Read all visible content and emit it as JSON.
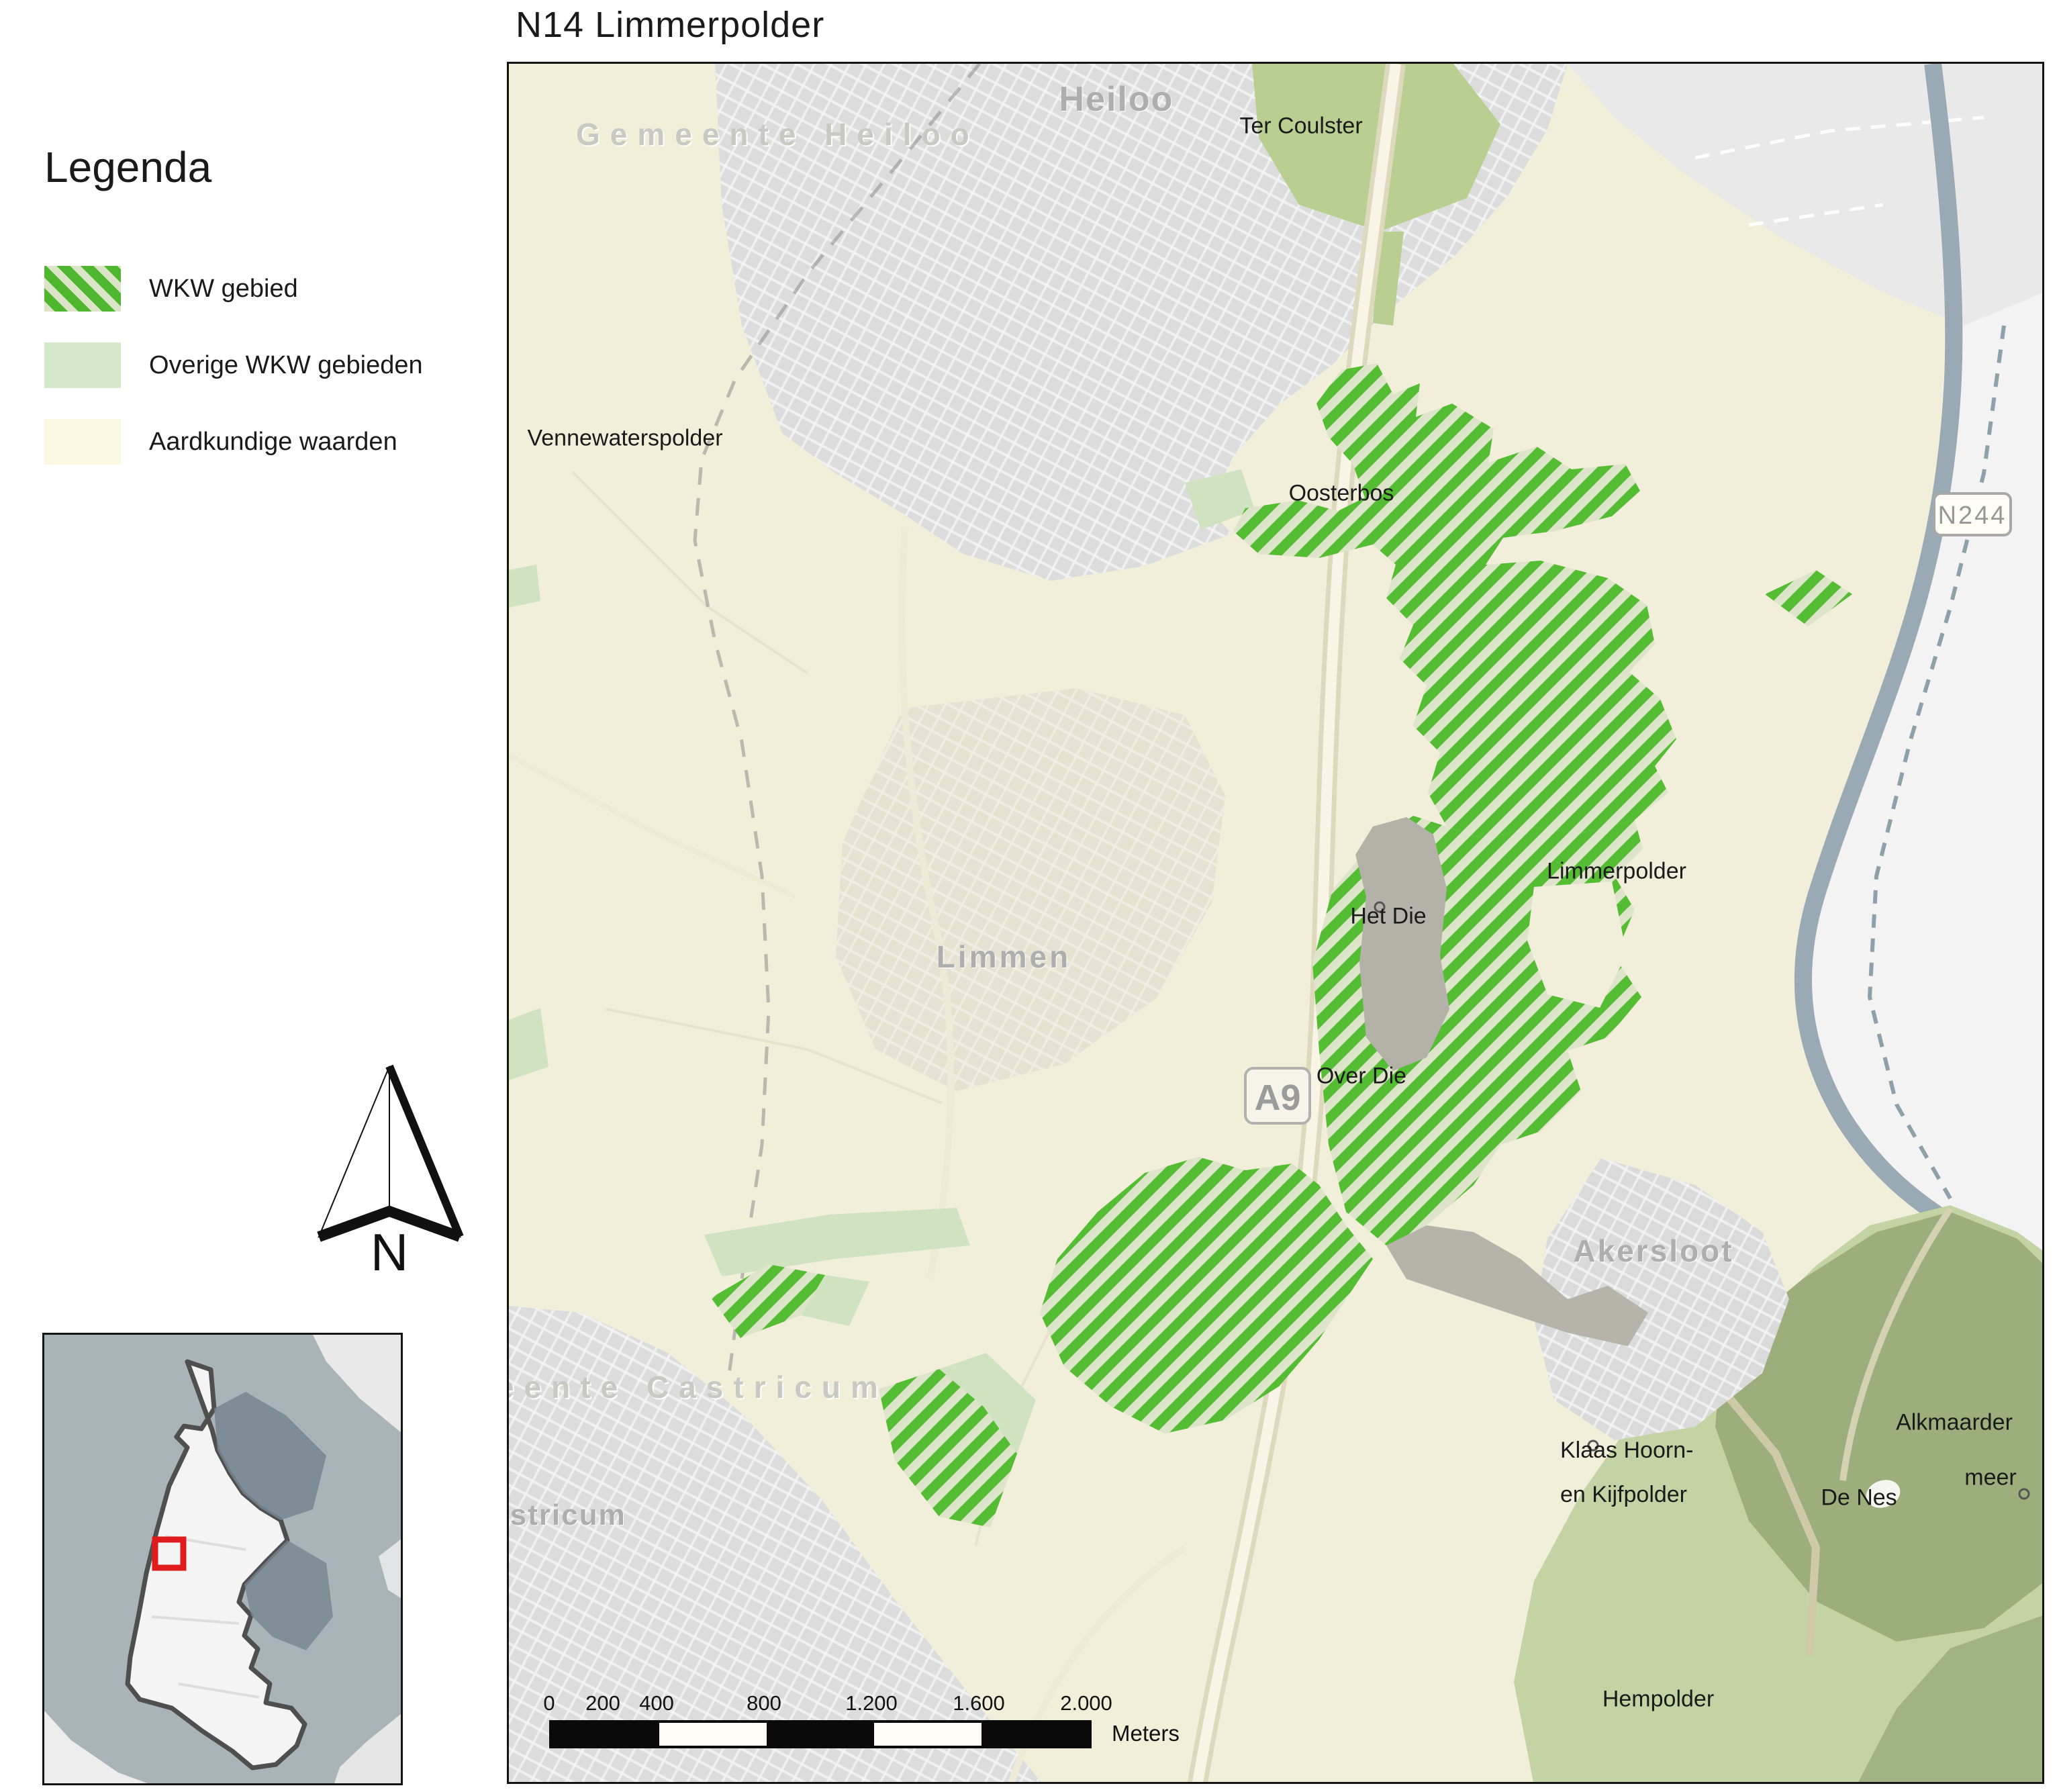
{
  "title": "N14  Limmerpolder",
  "legend": {
    "title": "Legenda",
    "items": [
      {
        "label": "WKW gebied",
        "swatch": "hatched-green"
      },
      {
        "label": "Overige WKW gebieden",
        "swatch": "light-green"
      },
      {
        "label": "Aardkundige waarden",
        "swatch": "cream"
      }
    ]
  },
  "north_arrow_label": "N",
  "scale_bar": {
    "ticks": [
      "0",
      "200",
      "400",
      "800",
      "1.200",
      "1.600",
      "2.000"
    ],
    "unit": "Meters"
  },
  "road_shields": {
    "n244": "N244",
    "a9": "A9"
  },
  "map_labels": {
    "heiloo": "Heiloo",
    "gemeente_heiloo": "Gemeente Heiloo",
    "ter_coulster": "Ter Coulster",
    "vennewaterspolder": "Vennewaterspolder",
    "oosterbos": "Oosterbos",
    "limmerpolder": "Limmerpolder",
    "het_die": "Het Die",
    "limmen": "Limmen",
    "over_die": "Over Die",
    "akersloot": "Akersloot",
    "gemeente_castricum_partial": "eente Castricum",
    "castricum_partial": "astricum",
    "klaas_hoorn_line1": "Klaas Hoorn-",
    "klaas_hoorn_line2": "en Kijfpolder",
    "de_nes": "De Nes",
    "alkmaarder": "Alkmaarder",
    "meer": "meer",
    "hempolder": "Hempolder"
  },
  "colors": {
    "wkw_stripe": "#55bd33",
    "wkw_background": "#dde4c9",
    "overige_wkw": "#cfe3c0",
    "aardkundige_waarden": "#f1eeda",
    "urban_gray": "#dcdcdc",
    "water_canal": "#99aab4",
    "forest_olive": "#9cae7c",
    "locator_highlight": "#e01b1b"
  }
}
